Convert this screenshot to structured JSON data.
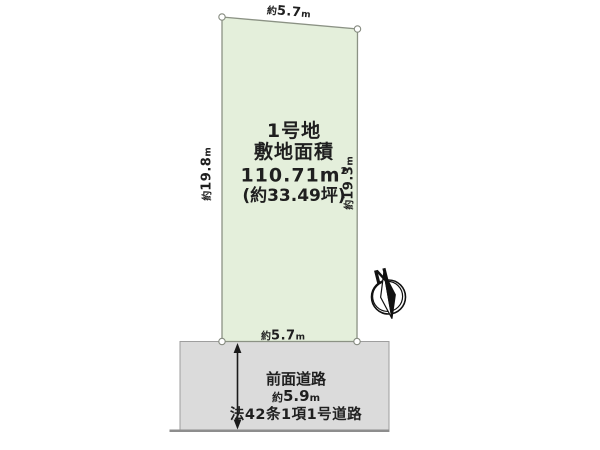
{
  "colors": {
    "plot_fill": "#e4efdb",
    "plot_stroke": "#8b9284",
    "road_fill": "#dbdbdb",
    "road_border": "#9e9e9e",
    "road_baseline": "#8d8d8d",
    "ink": "#1f1f1f"
  },
  "plot": {
    "title": "1号地",
    "subtitle": "敷地面積",
    "area_value": "110.71",
    "area_unit": "m",
    "area_sup": "2",
    "area_tsubo": "(約33.49坪)"
  },
  "dims": {
    "top": {
      "prefix": "約",
      "value": "5.7",
      "unit": "m"
    },
    "bottom": {
      "prefix": "約",
      "value": "5.7",
      "unit": "m"
    },
    "left": {
      "prefix": "約",
      "value": "19.8",
      "unit": "m"
    },
    "right": {
      "prefix": "約",
      "value": "19.3",
      "unit": "m"
    }
  },
  "road": {
    "name": "前面道路",
    "width": {
      "prefix": "約",
      "value": "5.9",
      "unit": "m"
    },
    "designation": "法42条1項1号道路"
  },
  "compass": {
    "north": "N"
  }
}
